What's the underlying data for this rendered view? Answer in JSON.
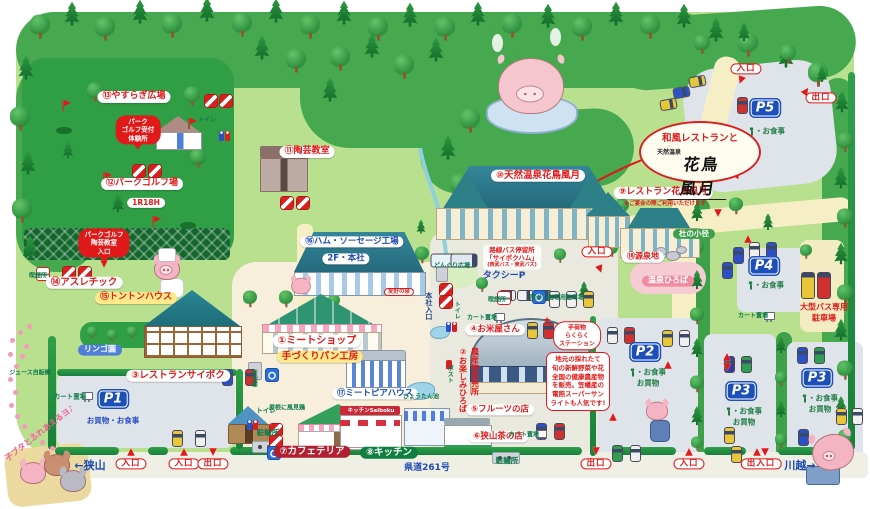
{
  "labels": {
    "yasuragi": "⑬やすらぎ広場",
    "golf_course": "⑫パークゴルフ場",
    "golf_holes": "1R18H",
    "pottery": "⑪陶芸教室",
    "ham_factory": "⑯ハム・ソーセージ工場",
    "head_office": "2F・本社",
    "athletic": "⑭アスレチック",
    "tonton": "⑮トントンハウス",
    "rest_saiboku": "③レストランサイボク",
    "apple": "リンゴ園",
    "juice": "ジュース自販機",
    "meat_shop": "①ミートショップ",
    "bread": "手づくりパン工房",
    "meatopia": "⑰ミートピアハウス",
    "hyotan": "ひょうたん池",
    "hotei": "布袋様",
    "vane": "屋根に風見鶏",
    "cart": "カート置場",
    "bike": "駐輪所",
    "toilet": "トイレ",
    "cafeteria": "⑦カフェテリア",
    "kitchen": "⑧キッチン",
    "kitchen_sign": "キッチンSaiboku",
    "road261": "県道261号",
    "sayama": "←狭山",
    "kawagoe": "川越→",
    "in": "入口",
    "out": "出口",
    "inout": "出入口",
    "onsen": "⑩天然温泉花鳥風月",
    "kacho": "⑨レストラン花鳥風月",
    "kacho_note": "※ご宴会の際ご利用いただけます",
    "taxi": "タクシーP",
    "donguri": "どんぐり広場",
    "mori": "杜の小径",
    "gensen": "⑱源泉地",
    "onsen_plaza": "温泉ひろば",
    "disabled": "障がい者専用駐車場",
    "smoking": "喫煙所",
    "rice": "④お米屋さん",
    "tanoshimi1": "②お楽しみひろば",
    "tanoshimi2": "農産物直売所",
    "fruit": "⑤フルーツの店",
    "tea": "⑥狭山茶の店",
    "honsha": "本社入口",
    "post": "ポスト",
    "yuko": "友好の泉",
    "piglets": "子ブタとふれあえるヨ♪",
    "cap_meal": "・お食事",
    "cap_shop": "お買物"
  },
  "balloon": {
    "line1": "和風レストランと",
    "line2": "天然温泉",
    "line3": "花鳥風月"
  },
  "golf_reception": [
    "パーク",
    "ゴルフ受付",
    "体験所"
  ],
  "golf_entrance": [
    "パークゴルフ",
    "陶芸教室",
    "入口"
  ],
  "bus_stop": [
    "路線バス停留所",
    "「サイボクハム」",
    "(西武バス・東武バス)"
  ],
  "baggage_station": [
    "手荷物",
    "らくらく",
    "ステーション"
  ],
  "market_note": [
    "地元の採れたて",
    "旬の新鮮野菜や花",
    "全国の健康農産物",
    "を販売。笠幡産の",
    "電照スーパーサン",
    "ライトも人気です!"
  ],
  "parking": {
    "p1": {
      "sign": "P1",
      "caption": "お買物・お食事"
    },
    "p2": {
      "sign": "P2"
    },
    "p3a": {
      "sign": "P3"
    },
    "p3b": {
      "sign": "P3"
    },
    "p4": {
      "sign": "P4"
    },
    "p5": {
      "sign": "P5"
    },
    "big_bus": [
      "大型バス専用",
      "駐車場"
    ]
  },
  "colors": {
    "accent_red": "#e01919",
    "parking_blue": "#1c4fb8",
    "map_green": "#b9e08f",
    "forest_green": "#46a84f",
    "hedge_green": "#1f8c3a",
    "road_cream": "#f6efc6",
    "lot_gray": "#dfe4ea"
  }
}
